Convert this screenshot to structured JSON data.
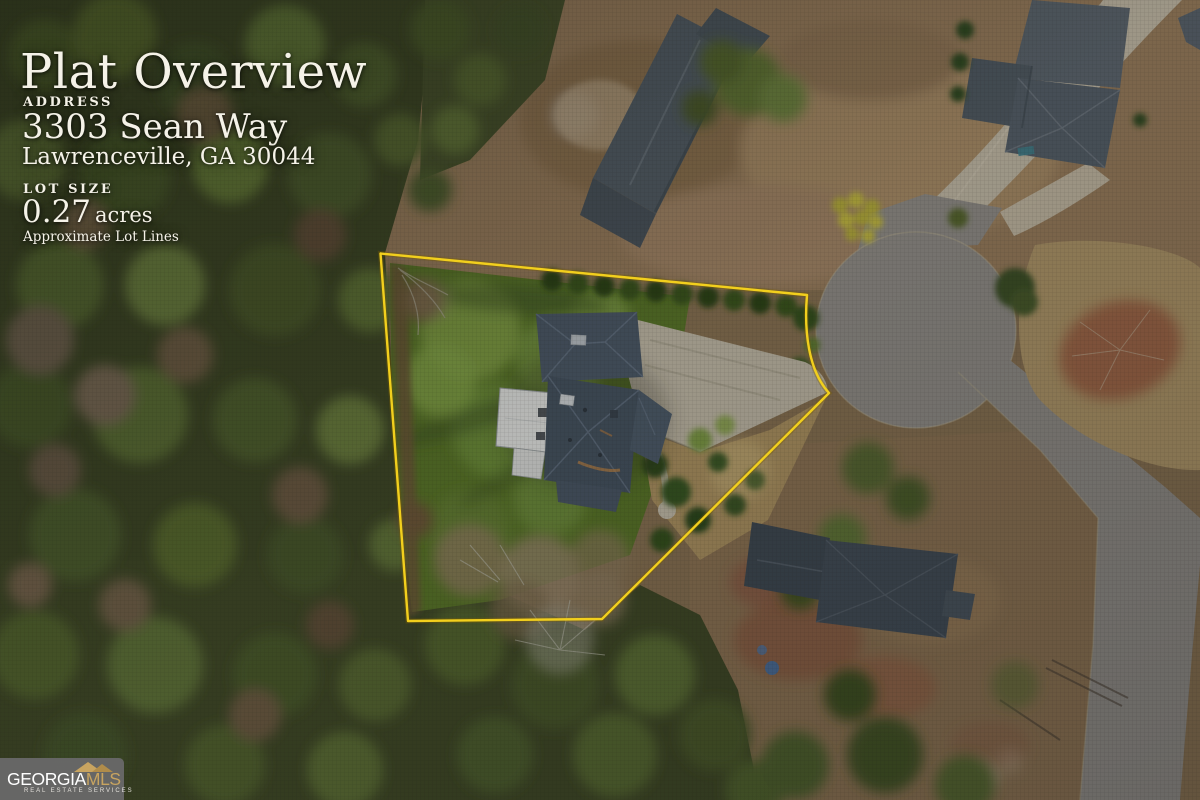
{
  "header": {
    "title": "Plat Overview"
  },
  "address": {
    "label": "ADDRESS",
    "line1": "3303 Sean Way",
    "line2": "Lawrenceville, GA 30044"
  },
  "lot": {
    "label": "LOT SIZE",
    "size_value": "0.27",
    "size_unit": "acres",
    "disclaimer": "Approximate Lot Lines"
  },
  "logo": {
    "brand_primary": "GEORGIA",
    "brand_secondary": "MLS",
    "tagline": "REAL ESTATE SERVICES",
    "gold_color": "#c8a460",
    "background_color": "#686868"
  },
  "map": {
    "boundary_color": "#f2cf1d",
    "boundary_glow_color": "#7a5e00",
    "overlay_text_color": "#f5f2e8"
  }
}
